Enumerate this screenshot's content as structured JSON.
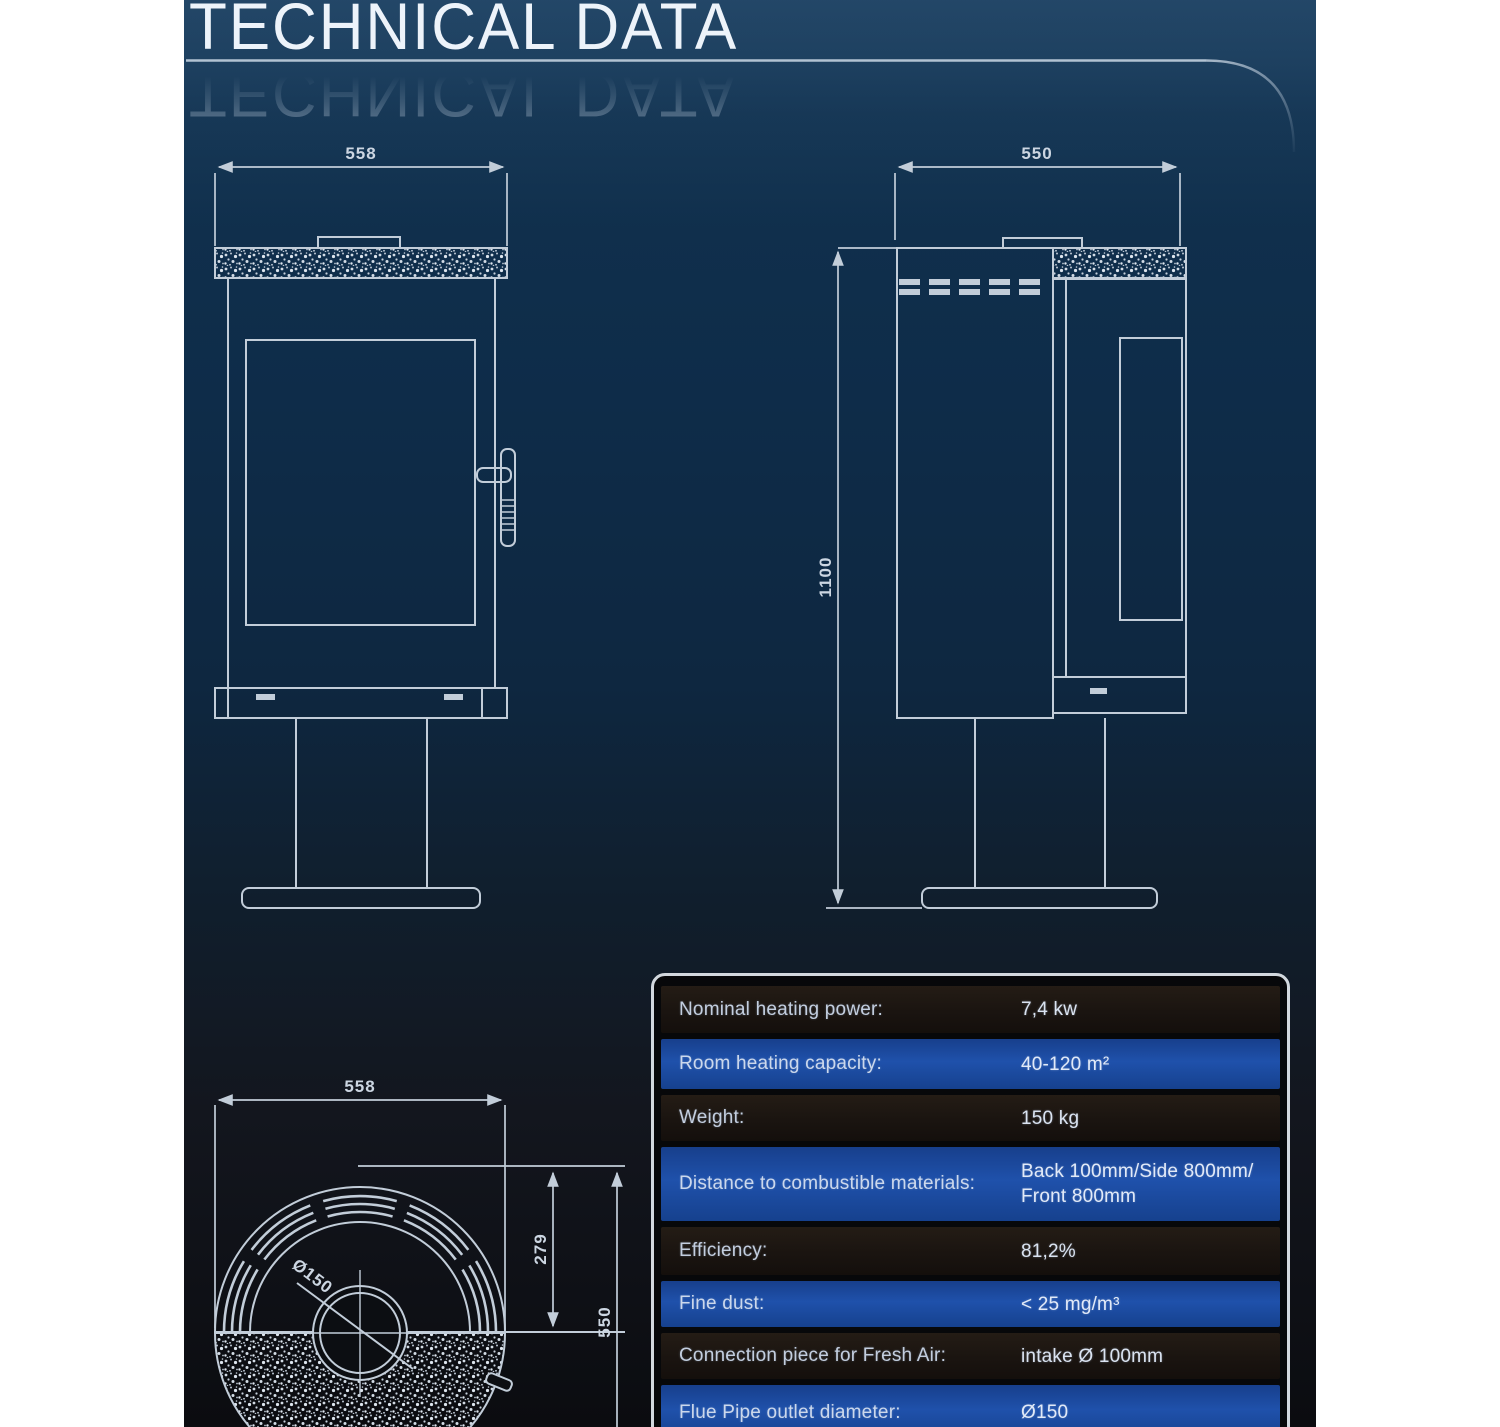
{
  "header": {
    "title": "TECHNICAL DATA"
  },
  "colors": {
    "panel_top": "#123350",
    "panel_bottom": "#0b0c10",
    "drawing_line": "#c2cdd9",
    "table_row_blue": "#1f51ab",
    "table_row_dark": "#1a1410",
    "table_border": "#d2d8de"
  },
  "drawings": {
    "front_view": {
      "width_label": "558"
    },
    "side_view": {
      "depth_label": "550",
      "height_label": "1100"
    },
    "top_view": {
      "width_label": "558",
      "flue_center_label": "279",
      "depth_label": "550",
      "flue_diameter_label": "Ø150"
    }
  },
  "spec_table": {
    "rows": [
      {
        "label": "Nominal heating power:",
        "value": "7,4 kw"
      },
      {
        "label": "Room heating capacity:",
        "value": "40-120 m²"
      },
      {
        "label": "Weight:",
        "value": "150 kg"
      },
      {
        "label": "Distance to combustible materials:",
        "value": "Back 100mm/Side 800mm/\nFront 800mm"
      },
      {
        "label": "Efficiency:",
        "value": "81,2%"
      },
      {
        "label": "Fine dust:",
        "value": "< 25 mg/m³"
      },
      {
        "label": "Connection piece for Fresh Air:",
        "value": "intake Ø 100mm"
      },
      {
        "label": "Flue Pipe outlet diameter:",
        "value": "Ø150"
      }
    ]
  }
}
